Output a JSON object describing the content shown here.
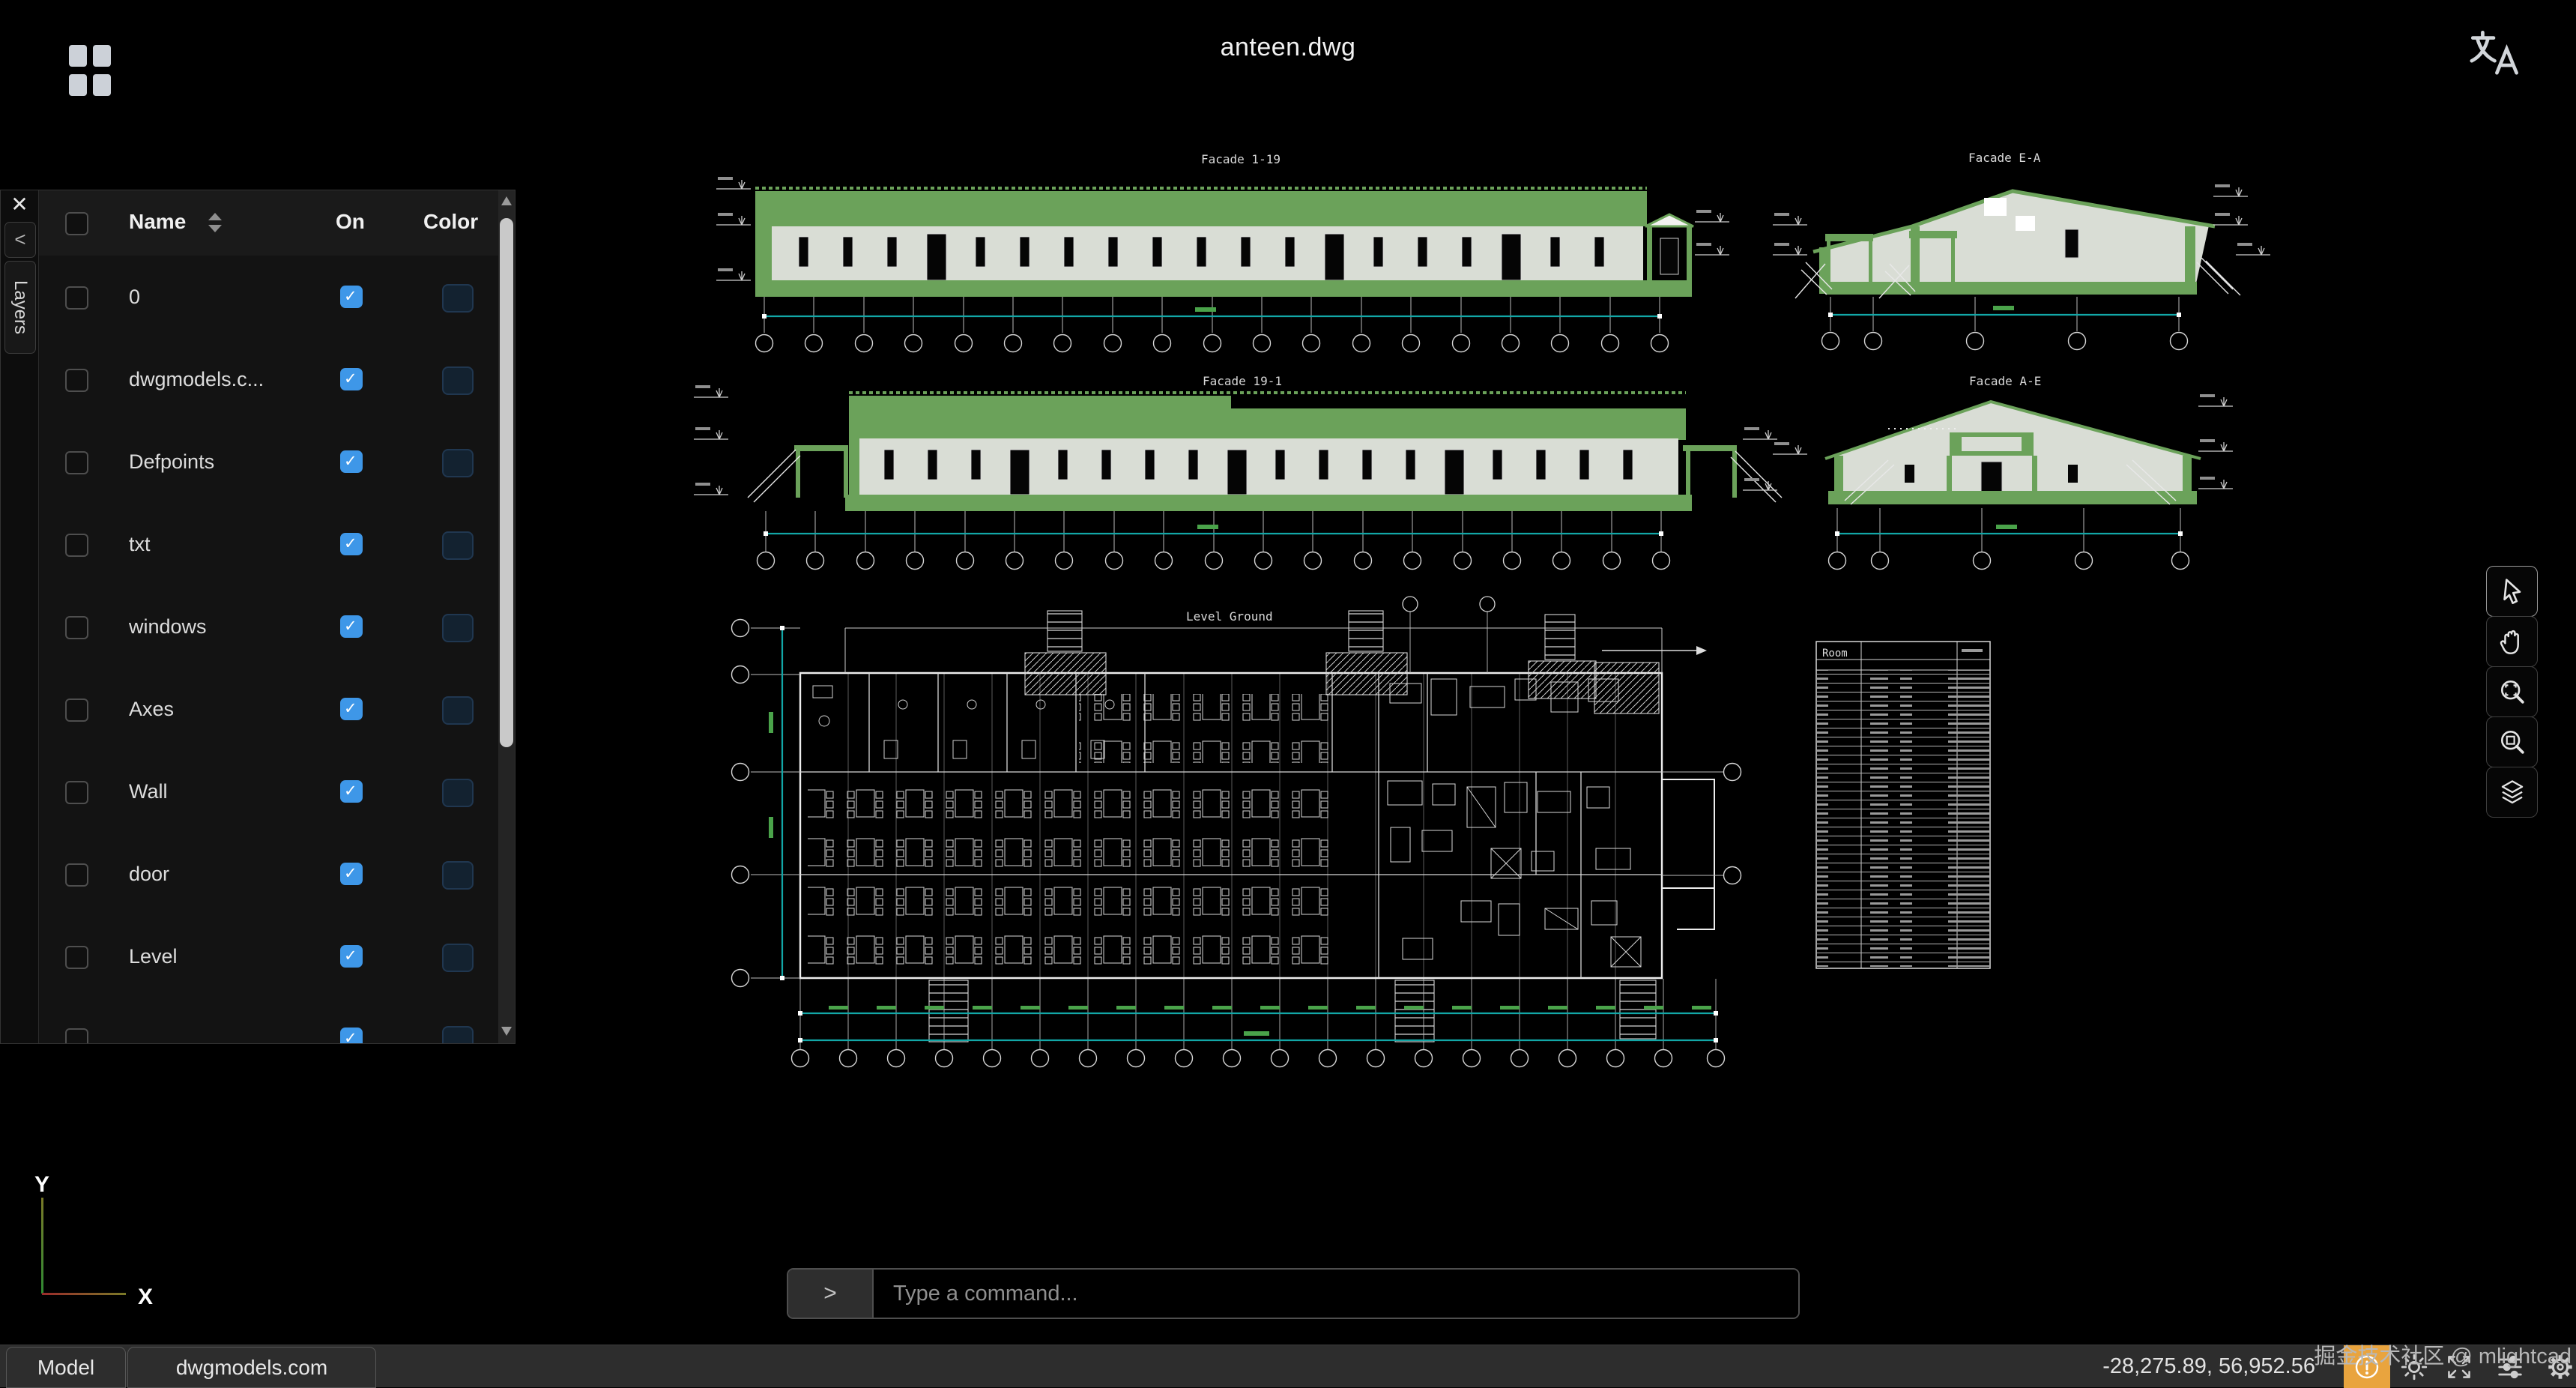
{
  "titlebar": {
    "title": "anteen.dwg"
  },
  "layers_panel": {
    "tab": "Layers",
    "header": {
      "name": "Name",
      "on": "On",
      "color": "Color"
    },
    "rows": [
      {
        "name": "0",
        "on": true
      },
      {
        "name": "dwgmodels.c...",
        "on": true
      },
      {
        "name": "Defpoints",
        "on": true
      },
      {
        "name": "txt",
        "on": true
      },
      {
        "name": "windows",
        "on": true
      },
      {
        "name": "Axes",
        "on": true
      },
      {
        "name": "Wall",
        "on": true
      },
      {
        "name": "door",
        "on": true
      },
      {
        "name": "Level",
        "on": true
      }
    ],
    "swatch_color": "#132230",
    "check_color": "#3e97e8"
  },
  "drawing": {
    "facade_1_19_label": "Facade 1-19",
    "facade_ea_label": "Facade E-A",
    "facade_19_1_label": "Facade 19-1",
    "facade_ae_label": "Facade A-E",
    "plan_label": "Level Ground",
    "room_table_header": "Room",
    "accent_green": "#6ba25a",
    "wall_gray": "#d9ddd5",
    "dim_teal": "#12a7a7"
  },
  "command_bar": {
    "prompt": ">",
    "placeholder": "Type a command..."
  },
  "status_bar": {
    "model_tab": "Model",
    "site_tab": "dwgmodels.com",
    "coordinates": "-28,275.89, 56,952.56"
  },
  "watermark": "掘金技术社区 @ mlightcad",
  "ucs": {
    "x": "X",
    "y": "Y"
  }
}
